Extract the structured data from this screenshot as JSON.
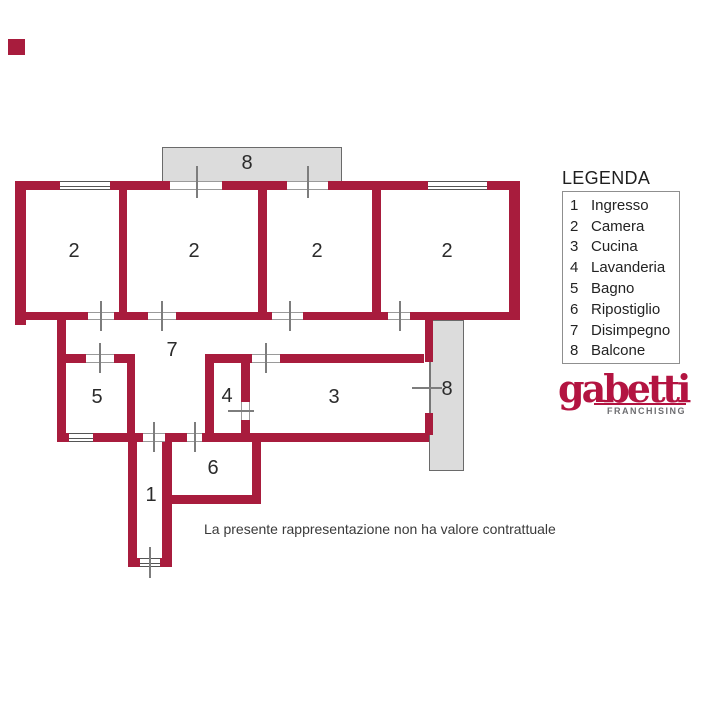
{
  "plan": {
    "room_labels": [
      {
        "id": "camera-1",
        "text": "2"
      },
      {
        "id": "camera-2",
        "text": "2"
      },
      {
        "id": "camera-3",
        "text": "2"
      },
      {
        "id": "camera-4",
        "text": "2"
      },
      {
        "id": "disimpegno",
        "text": "7"
      },
      {
        "id": "bagno",
        "text": "5"
      },
      {
        "id": "lavanderia",
        "text": "4"
      },
      {
        "id": "cucina",
        "text": "3"
      },
      {
        "id": "ripostiglio",
        "text": "6"
      },
      {
        "id": "ingresso",
        "text": "1"
      },
      {
        "id": "balcone-top",
        "text": "8"
      },
      {
        "id": "balcone-right",
        "text": "8"
      }
    ]
  },
  "legend": {
    "title": "LEGENDA",
    "items": [
      {
        "number": "1",
        "label": "Ingresso"
      },
      {
        "number": "2",
        "label": "Camera"
      },
      {
        "number": "3",
        "label": "Cucina"
      },
      {
        "number": "4",
        "label": "Lavanderia"
      },
      {
        "number": "5",
        "label": "Bagno"
      },
      {
        "number": "6",
        "label": "Ripostiglio"
      },
      {
        "number": "7",
        "label": "Disimpegno"
      },
      {
        "number": "8",
        "label": "Balcone"
      }
    ]
  },
  "brand": {
    "name": "gabetti",
    "tagline": "FRANCHISING"
  },
  "disclaimer": "La presente rappresentazione non ha valore contrattuale",
  "colors": {
    "wall": "#a81c3d",
    "balcony_fill": "#dcdcdc",
    "brand_red": "#b31441"
  }
}
